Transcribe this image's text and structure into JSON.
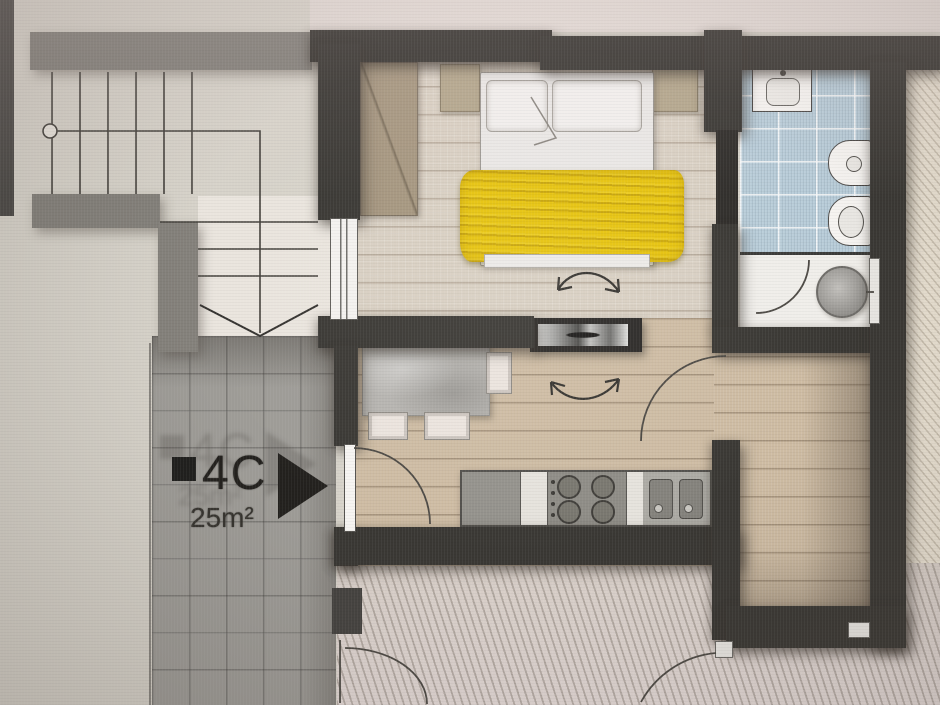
{
  "floor_plan": {
    "unit_label": "4C",
    "unit_area": "25m²",
    "colors": {
      "wall_dark": "#3a3834",
      "wall_gray": "#84817b",
      "floor_wood": "#cdbba2",
      "floor_bedroom": "#d8cfc2",
      "tile_bathroom": "#b9cdd9",
      "tile_landing": "#9d9b96",
      "blanket_yellow": "#e6c30e",
      "exterior_hatch": "#ded5ce"
    },
    "legend": {
      "fixtures": [
        "staircase-up",
        "handrail",
        "stairs-direction-arrow",
        "unit-marker-square",
        "unit-direction-triangle",
        "double-bed",
        "pillow",
        "duvet",
        "wardrobe",
        "nightstand",
        "dining-table",
        "chair",
        "rotating-tv-panel",
        "rotation-arrow",
        "kitchen-counter",
        "cooktop-burners",
        "kitchen-sink",
        "fridge-cabinet",
        "entry-door-swing",
        "interior-door-swing",
        "washbasin",
        "bidet",
        "toilet",
        "shower",
        "window"
      ]
    }
  }
}
